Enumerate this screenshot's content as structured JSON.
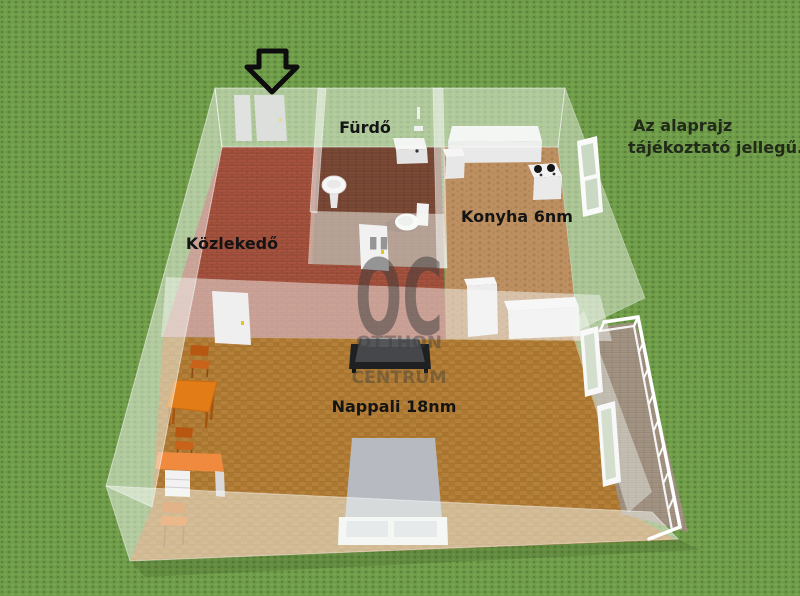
{
  "note": {
    "line1": "Az alaprajz",
    "line2": "tájékoztató jellegű."
  },
  "watermark": {
    "logo": "ÖC",
    "line1": "OTTHON",
    "line2": "CENTRUM"
  },
  "rooms": {
    "hallway": {
      "label": "Közlekedő"
    },
    "bathroom": {
      "label": "Fürdő"
    },
    "kitchen": {
      "label": "Konyha 6nm"
    },
    "living": {
      "label": "Nappali 18nm"
    }
  },
  "icons": {
    "entrance_arrow": "down-arrow-outline"
  },
  "colors": {
    "background": "#6f9c49",
    "hallway_floor": "#a5523e",
    "bathroom_floor": "#7b4a36",
    "kitchen_floor": "#bd9062",
    "living_floor": "#b5813a",
    "balcony_floor": "#a29383",
    "glass_wall": "rgba(245,249,243,0.5)",
    "accent_furniture": "#e17c17",
    "sofa": "#1f2021",
    "label_text": "#141414",
    "watermark_gray": "#3c3c3c"
  },
  "furniture": [
    "kitchen-counter",
    "kitchen-cabinet",
    "stove",
    "bath-counter",
    "pedestal-sink",
    "toilet",
    "wardrobe",
    "sideboard",
    "sofa",
    "bed",
    "dining-table",
    "desk",
    "chairs",
    "doors",
    "windows",
    "balcony-railing"
  ]
}
